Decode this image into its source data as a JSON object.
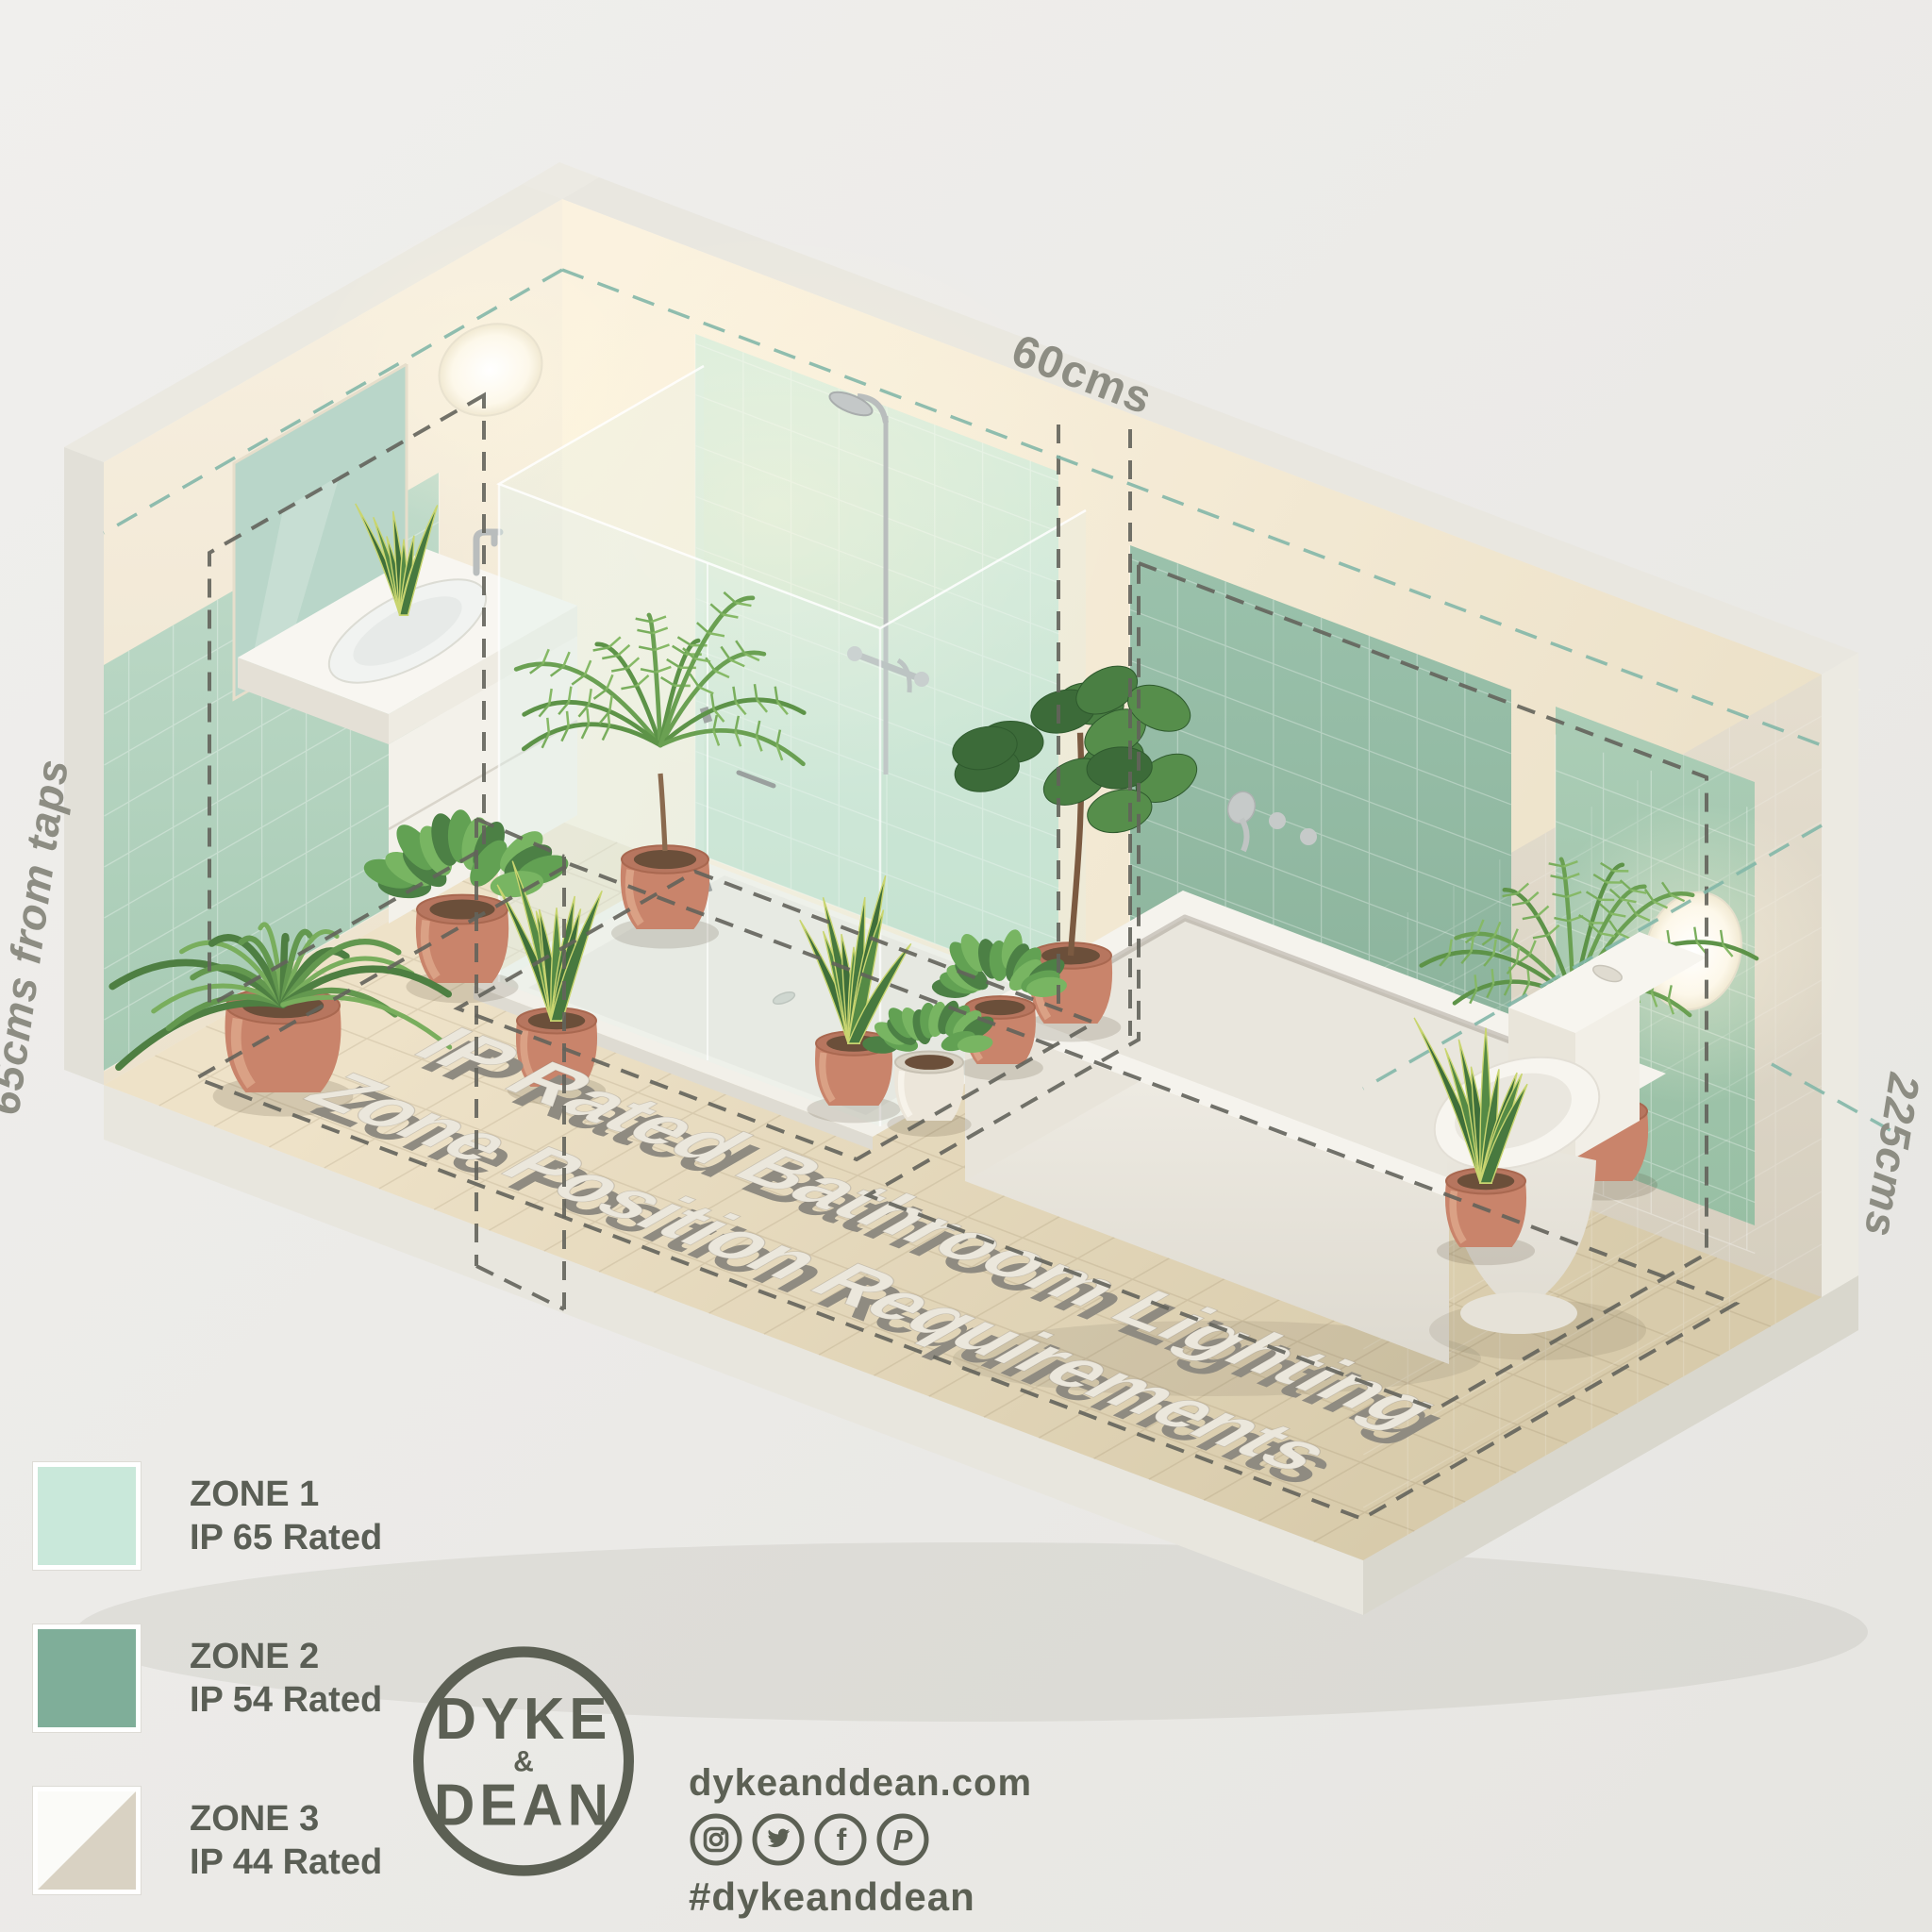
{
  "dimensions": {
    "top": "60cms",
    "left": "65cms from taps",
    "right": "225cms"
  },
  "floor_text": {
    "line1": "IP Rated Bathroom Lighting",
    "line2": "Zone Position Requirements"
  },
  "legend": {
    "items": [
      {
        "zone": "ZONE 1",
        "rating": "IP 65 Rated",
        "swatch": "#c9e8da"
      },
      {
        "zone": "ZONE 2",
        "rating": "IP 54 Rated",
        "swatch": "#7fae99"
      },
      {
        "zone": "ZONE 3",
        "rating": "IP 44 Rated",
        "swatch_top": "#fbfbf8",
        "swatch_bottom": "#d9d2c3"
      }
    ]
  },
  "branding": {
    "logo_top": "DYKE",
    "logo_amp": "&",
    "logo_bottom": "DEAN",
    "website": "dykeanddean.com",
    "hashtag": "#dykeanddean",
    "social": [
      {
        "name": "instagram",
        "glyph": ""
      },
      {
        "name": "twitter",
        "glyph": ""
      },
      {
        "name": "facebook",
        "glyph": "f"
      },
      {
        "name": "pinterest",
        "glyph": "P"
      }
    ]
  },
  "colors": {
    "background": "#ecebe9",
    "zone1_mint": "#c9e8da",
    "zone2_green": "#7fae99",
    "zone3_beige": "#d9d2c3",
    "dash_dark": "#63635b",
    "dash_teal": "#83b7a9",
    "label_gray": "#8d8d83",
    "text_gray": "#5a5e55",
    "logo_gray": "#5c6054",
    "terracotta": "#c9846b",
    "floor_beige": "#e4d8bb",
    "wall_cream": "#f6eedb"
  }
}
